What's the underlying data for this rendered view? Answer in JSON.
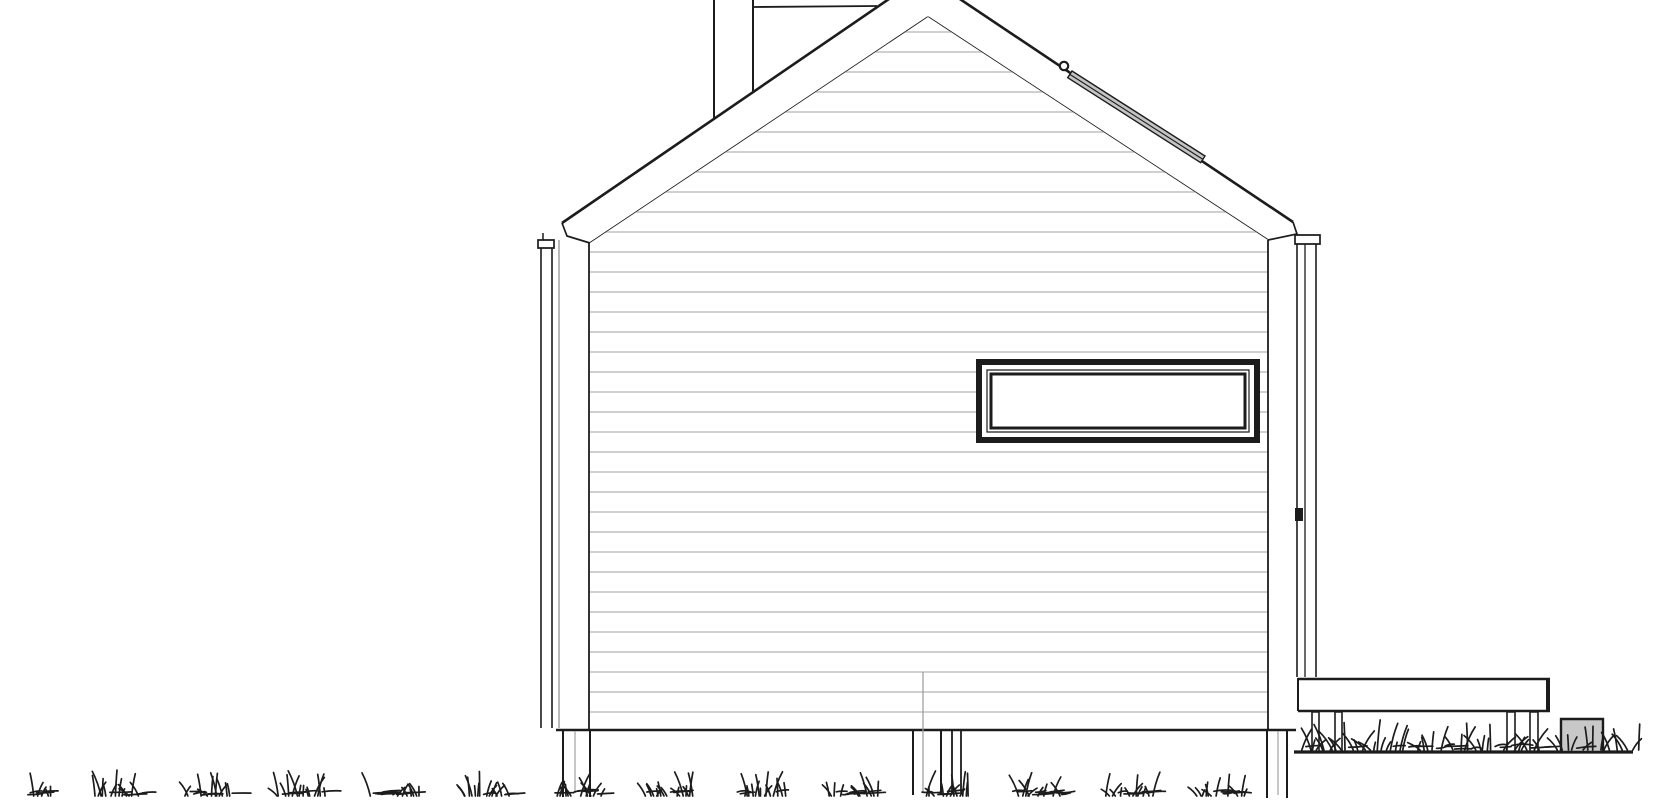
{
  "meta": {
    "title": "house-side-elevation-drawing",
    "description": "black and white architectural elevation of a gabled cabin with deck"
  },
  "canvas": {
    "width": 1670,
    "height": 800,
    "background": "#ffffff"
  },
  "colors": {
    "line": "#1c1c1c",
    "siding": "#b3b3b3",
    "dim": "#8a8a8a",
    "pipe": "#9a9a9a",
    "postmid": "#999999",
    "grayFill": "#c8c8c8",
    "stripFill": "#c4c4c4",
    "white": "#ffffff"
  },
  "defs": {
    "wallClip": [
      [
        590,
        243
      ],
      [
        928,
        17
      ],
      [
        1268,
        240
      ],
      [
        1268,
        731
      ],
      [
        590,
        731
      ]
    ]
  },
  "layers": [
    {
      "name": "chimney",
      "items": [
        {
          "t": "pgon",
          "n": "chimney-body",
          "pts": [
            [
              714,
              0
            ],
            [
              753,
              0
            ],
            [
              753,
              92
            ],
            [
              714,
              119
            ]
          ],
          "f": "white"
        },
        {
          "t": "line",
          "n": "chimney-left-edge",
          "p": [
            714,
            0,
            714,
            119
          ],
          "w": 2
        },
        {
          "t": "line",
          "n": "chimney-right-edge",
          "p": [
            753,
            0,
            753,
            92
          ],
          "w": 2
        },
        {
          "t": "line",
          "n": "chimney-cap-line",
          "p": [
            753,
            7,
            877,
            6
          ],
          "w": 1.8
        }
      ]
    },
    {
      "name": "roof",
      "items": [
        {
          "t": "pgon",
          "n": "roof-band",
          "pts": [
            [
              562,
              223
            ],
            [
              924,
              -25
            ],
            [
              1293,
              222
            ],
            [
              1297,
              234
            ],
            [
              1268,
              240
            ],
            [
              928,
              17
            ],
            [
              590,
              243
            ],
            [
              567,
              236
            ]
          ],
          "f": "white"
        },
        {
          "t": "line",
          "n": "roof-outer-left",
          "p": [
            562,
            223,
            924,
            -25
          ],
          "w": 2.6
        },
        {
          "t": "line",
          "n": "roof-outer-right",
          "p": [
            924,
            -25,
            1293,
            222
          ],
          "w": 2.6
        },
        {
          "t": "pline",
          "n": "roof-fascia-left",
          "pts": [
            [
              562,
              223
            ],
            [
              567,
              236
            ],
            [
              590,
              243
            ]
          ],
          "w": 1.7
        },
        {
          "t": "pline",
          "n": "roof-fascia-right",
          "pts": [
            [
              1293,
              222
            ],
            [
              1297,
              234
            ],
            [
              1268,
              240
            ]
          ],
          "w": 1.7
        },
        {
          "t": "line",
          "n": "roof-inner-left",
          "p": [
            590,
            243,
            928,
            17
          ],
          "w": 1.7
        },
        {
          "t": "line",
          "n": "roof-inner-right",
          "p": [
            928,
            17,
            1268,
            240
          ],
          "w": 1.7
        }
      ]
    },
    {
      "name": "wall",
      "items": [
        {
          "t": "pgon",
          "n": "wall-face",
          "pts": [
            [
              590,
              243
            ],
            [
              928,
              17
            ],
            [
              1268,
              240
            ],
            [
              1268,
              731
            ],
            [
              590,
              731
            ]
          ],
          "f": "white"
        },
        {
          "t": "siding",
          "n": "siding-lines",
          "y0": 32,
          "step": 20,
          "yEnd": 712,
          "x1": 585,
          "x2": 1270,
          "w": 1.2,
          "c": "siding",
          "clip": true
        },
        {
          "t": "line",
          "n": "wall-left-edge",
          "p": [
            589,
            243,
            589,
            730
          ],
          "w": 1.8
        },
        {
          "t": "line",
          "n": "wall-right-edge",
          "p": [
            1268,
            240,
            1268,
            730
          ],
          "w": 1.8
        }
      ]
    },
    {
      "name": "window",
      "items": [
        {
          "t": "rect",
          "n": "window-outer-frame",
          "r": [
            979,
            362,
            278,
            78
          ],
          "f": "white",
          "s": "line",
          "w": 6
        },
        {
          "t": "rect",
          "n": "window-mid-frame",
          "r": [
            987,
            370,
            262,
            62
          ],
          "s": "line",
          "w": 1.2
        },
        {
          "t": "rect",
          "n": "window-sash",
          "r": [
            991,
            374,
            254,
            54
          ],
          "s": "line",
          "w": 3
        }
      ]
    },
    {
      "name": "roof-strip",
      "items": [
        {
          "t": "pgon",
          "n": "roof-strip-band",
          "pts": [
            [
              1072,
              71
            ],
            [
              1205,
              156
            ],
            [
              1200.7,
              162.7
            ],
            [
              1067.7,
              77.7
            ]
          ],
          "f": "stripFill",
          "s": "line",
          "w": 1.4
        },
        {
          "t": "line",
          "n": "roof-strip-midline",
          "p": [
            1069.9,
            74.4,
            1202.9,
            159.4
          ],
          "w": 1.1
        },
        {
          "t": "circle",
          "n": "roof-strip-knob",
          "c": [
            1064,
            66
          ],
          "rad": 4.2,
          "f": "white",
          "s": "line",
          "w": 2.2
        }
      ]
    },
    {
      "name": "trim-left",
      "items": [
        {
          "t": "line",
          "n": "corner-board-left",
          "p": [
            559,
            240,
            559,
            728
          ],
          "w": 1.2,
          "c": "dim"
        },
        {
          "t": "rect",
          "n": "downspout-left-cap",
          "r": [
            538,
            240,
            16,
            8
          ],
          "s": "line",
          "w": 1.7
        },
        {
          "t": "line",
          "n": "downspout-left-tick",
          "p": [
            543,
            233,
            543,
            240
          ],
          "w": 1.5
        },
        {
          "t": "line",
          "n": "downspout-left-outer",
          "p": [
            541,
            248,
            541,
            728
          ],
          "w": 1.6
        },
        {
          "t": "line",
          "n": "downspout-left-inner",
          "p": [
            552,
            248,
            552,
            728
          ],
          "w": 1.6
        }
      ]
    },
    {
      "name": "trim-right",
      "items": [
        {
          "t": "rect",
          "n": "downspout-right-cap",
          "r": [
            1295,
            235,
            25,
            9
          ],
          "s": "line",
          "w": 1.7
        },
        {
          "t": "line",
          "n": "downspout-right-line1",
          "p": [
            1297,
            244,
            1297,
            677
          ],
          "w": 1.6
        },
        {
          "t": "line",
          "n": "downspout-right-line2",
          "p": [
            1305,
            244,
            1305,
            677
          ],
          "w": 1.3
        },
        {
          "t": "line",
          "n": "downspout-right-line3",
          "p": [
            1316,
            244,
            1316,
            677
          ],
          "w": 1.6
        },
        {
          "t": "rect",
          "n": "downspout-bracket",
          "r": [
            1295,
            508,
            8,
            13
          ],
          "f": "line"
        }
      ]
    },
    {
      "name": "floor",
      "items": [
        {
          "t": "line",
          "n": "wall-bottom-line",
          "p": [
            556,
            730,
            1296,
            730
          ],
          "w": 2.6
        }
      ]
    },
    {
      "name": "posts",
      "items": [
        {
          "t": "line",
          "n": "post-left-edge1",
          "p": [
            563,
            731,
            563,
            797
          ],
          "w": 2
        },
        {
          "t": "line",
          "n": "post-left-edge2",
          "p": [
            590,
            731,
            590,
            797
          ],
          "w": 2
        },
        {
          "t": "line",
          "n": "post-left-mid",
          "p": [
            575,
            731,
            575,
            793
          ],
          "w": 1.1,
          "c": "postmid"
        },
        {
          "t": "line",
          "n": "post-center-edge1",
          "p": [
            913,
            731,
            913,
            795
          ],
          "w": 2
        },
        {
          "t": "line",
          "n": "post-center-edge2",
          "p": [
            941,
            731,
            941,
            795
          ],
          "w": 2
        },
        {
          "t": "line",
          "n": "post-center2-edge1",
          "p": [
            952,
            731,
            952,
            794
          ],
          "w": 1.8
        },
        {
          "t": "line",
          "n": "post-center2-edge2",
          "p": [
            961,
            731,
            961,
            794
          ],
          "w": 1.8
        },
        {
          "t": "line",
          "n": "post-right-edge1",
          "p": [
            1267,
            731,
            1267,
            798
          ],
          "w": 2
        },
        {
          "t": "line",
          "n": "post-right-edge2",
          "p": [
            1287,
            731,
            1287,
            798
          ],
          "w": 2
        },
        {
          "t": "line",
          "n": "post-right-mid",
          "p": [
            1278,
            731,
            1278,
            795
          ],
          "w": 1.1,
          "c": "postmid"
        }
      ]
    },
    {
      "name": "pipe",
      "items": [
        {
          "t": "line",
          "n": "vent-pipe",
          "p": [
            923,
            672,
            923,
            792
          ],
          "w": 1.2,
          "c": "pipe"
        }
      ]
    },
    {
      "name": "deck",
      "items": [
        {
          "t": "rect",
          "n": "deck-band",
          "r": [
            1298,
            678,
            252,
            34
          ],
          "f": "white"
        },
        {
          "t": "line",
          "n": "deck-top-edge",
          "p": [
            1298,
            679,
            1550,
            679
          ],
          "w": 2.4
        },
        {
          "t": "line",
          "n": "deck-bottom-edge",
          "p": [
            1298,
            711,
            1550,
            711
          ],
          "w": 2.6
        },
        {
          "t": "line",
          "n": "deck-left-edge",
          "p": [
            1298,
            678,
            1298,
            711
          ],
          "w": 2
        },
        {
          "t": "line",
          "n": "deck-right-edge",
          "p": [
            1548,
            678,
            1548,
            712
          ],
          "w": 4
        },
        {
          "t": "rect",
          "n": "deck-post-1",
          "r": [
            1312,
            712,
            7,
            40
          ],
          "f": "white",
          "s": "line",
          "w": 1.6
        },
        {
          "t": "rect",
          "n": "deck-post-2",
          "r": [
            1335,
            712,
            7,
            40
          ],
          "f": "white",
          "s": "line",
          "w": 1.6
        },
        {
          "t": "rect",
          "n": "deck-post-3",
          "r": [
            1507,
            712,
            8,
            40
          ],
          "f": "white",
          "s": "line",
          "w": 1.6
        },
        {
          "t": "rect",
          "n": "deck-post-4",
          "r": [
            1530,
            712,
            8,
            40
          ],
          "f": "white",
          "s": "line",
          "w": 1.6
        },
        {
          "t": "line",
          "n": "ground-line-right",
          "p": [
            1294,
            752,
            1633,
            752
          ],
          "w": 3.2
        },
        {
          "t": "rect",
          "n": "utility-box",
          "r": [
            1561,
            719,
            42,
            33
          ],
          "f": "grayFill",
          "s": "line",
          "w": 2.4
        }
      ]
    },
    {
      "name": "grass-under-deck",
      "items": [
        {
          "t": "grass",
          "n": "grass-under-deck",
          "x1": 1300,
          "x2": 1545,
          "base": 750,
          "hMin": 7,
          "hMax": 36,
          "num": 62,
          "lean": 14,
          "flat": 0.18,
          "seed": 11
        }
      ]
    },
    {
      "name": "grass-right",
      "items": [
        {
          "t": "grass",
          "n": "grass-right-of-deck",
          "x1": 1554,
          "x2": 1640,
          "base": 750,
          "hMin": 7,
          "hMax": 28,
          "num": 16,
          "lean": 12,
          "flat": 0.1,
          "seed": 5
        }
      ]
    },
    {
      "name": "grass-bottom",
      "items": [
        {
          "t": "grass",
          "n": "grass-bottom-strip",
          "x1": 26,
          "x2": 1264,
          "base": 796,
          "hMin": 6,
          "hMax": 26,
          "num": 235,
          "lean": 10,
          "flat": 0.32,
          "cluster": 92,
          "seed": 3
        }
      ]
    }
  ]
}
